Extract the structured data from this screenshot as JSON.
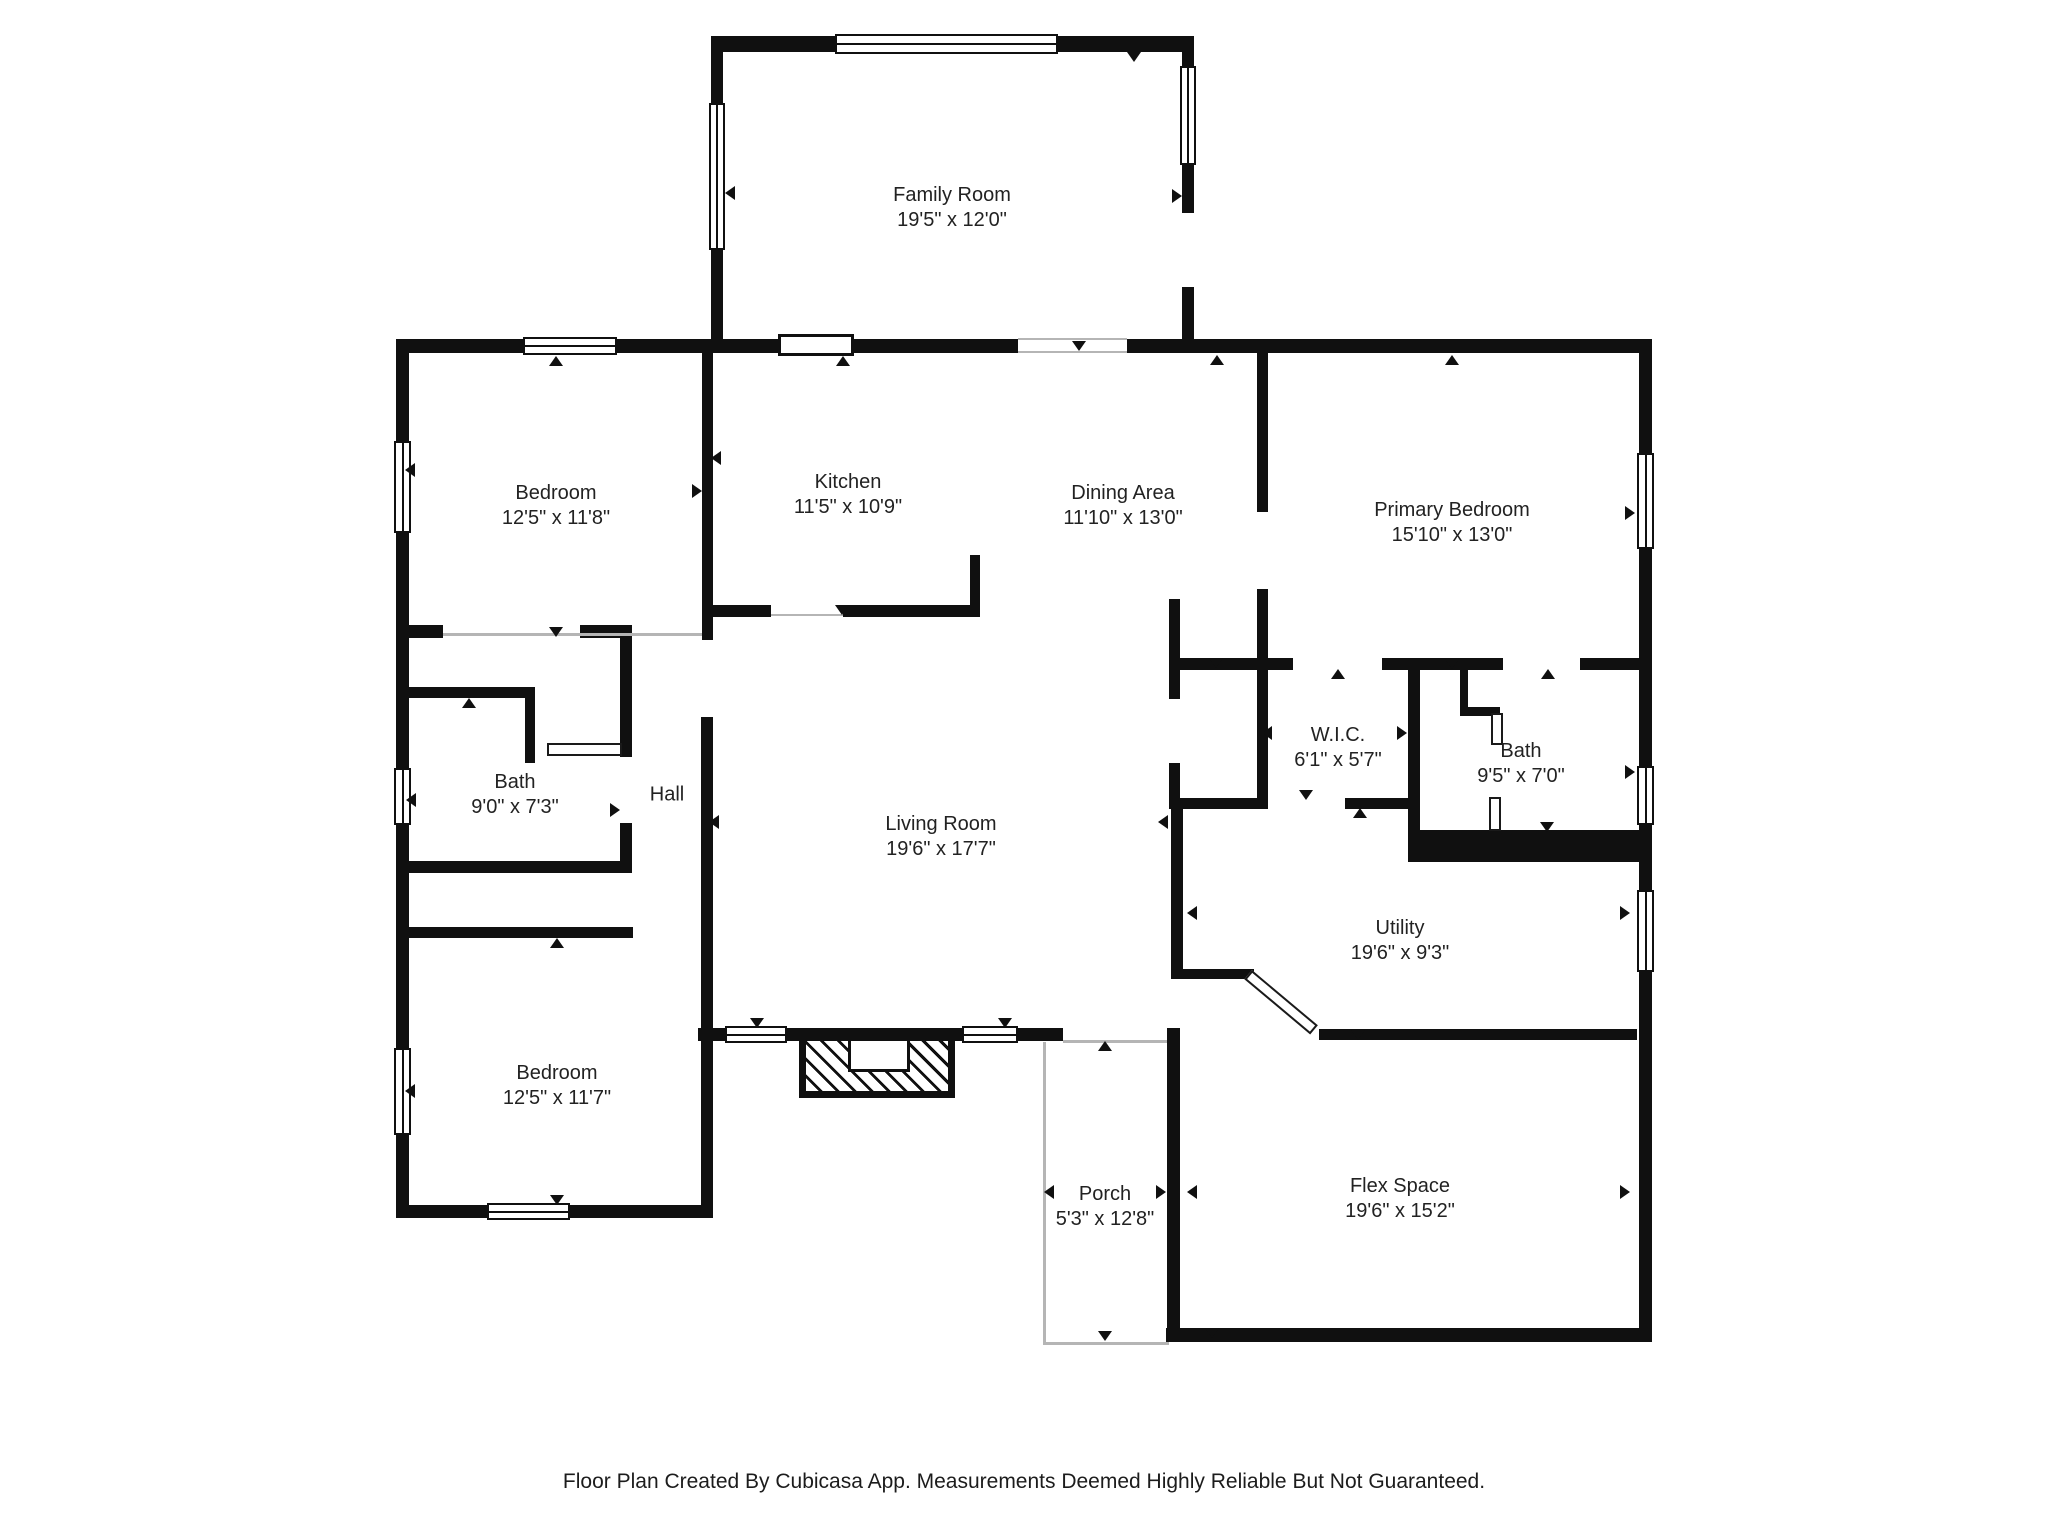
{
  "footer": {
    "text": "Floor Plan Created By Cubicasa App. Measurements Deemed Highly Reliable But Not Guaranteed."
  },
  "rooms": [
    {
      "id": "family-room",
      "name": "Family Room",
      "dims": "19'5\" x 12'0\"",
      "cx": 952,
      "cy": 208
    },
    {
      "id": "bedroom-top",
      "name": "Bedroom",
      "dims": "12'5\" x 11'8\"",
      "cx": 556,
      "cy": 506
    },
    {
      "id": "kitchen",
      "name": "Kitchen",
      "dims": "11'5\" x 10'9\"",
      "cx": 848,
      "cy": 495
    },
    {
      "id": "dining-area",
      "name": "Dining Area",
      "dims": "11'10\" x 13'0\"",
      "cx": 1123,
      "cy": 506
    },
    {
      "id": "primary-bedroom",
      "name": "Primary Bedroom",
      "dims": "15'10\" x 13'0\"",
      "cx": 1452,
      "cy": 523
    },
    {
      "id": "bath-left",
      "name": "Bath",
      "dims": "9'0\" x 7'3\"",
      "cx": 515,
      "cy": 795
    },
    {
      "id": "hall",
      "name": "Hall",
      "dims": "",
      "cx": 667,
      "cy": 795
    },
    {
      "id": "wic",
      "name": "W.I.C.",
      "dims": "6'1\" x 5'7\"",
      "cx": 1338,
      "cy": 748
    },
    {
      "id": "bath-right",
      "name": "Bath",
      "dims": "9'5\" x 7'0\"",
      "cx": 1521,
      "cy": 764
    },
    {
      "id": "living-room",
      "name": "Living Room",
      "dims": "19'6\" x 17'7\"",
      "cx": 941,
      "cy": 837
    },
    {
      "id": "utility",
      "name": "Utility",
      "dims": "19'6\" x 9'3\"",
      "cx": 1400,
      "cy": 941
    },
    {
      "id": "bedroom-bottom",
      "name": "Bedroom",
      "dims": "12'5\" x 11'7\"",
      "cx": 557,
      "cy": 1086
    },
    {
      "id": "flex-space",
      "name": "Flex Space",
      "dims": "19'6\" x 15'2\"",
      "cx": 1400,
      "cy": 1199
    },
    {
      "id": "porch",
      "name": "Porch",
      "dims": "5'3\" x 12'8\"",
      "cx": 1105,
      "cy": 1207
    }
  ],
  "plan": {
    "wall_color": "#101010",
    "walls": [
      [
        711,
        36,
        483,
        16
      ],
      [
        396,
        339,
        1256,
        14
      ],
      [
        713,
        605,
        267,
        12
      ],
      [
        408,
        625,
        224,
        13
      ],
      [
        408,
        687,
        127,
        11
      ],
      [
        408,
        861,
        224,
        12
      ],
      [
        408,
        927,
        225,
        11
      ],
      [
        396,
        1205,
        314,
        13
      ],
      [
        698,
        1028,
        365,
        13
      ],
      [
        1169,
        658,
        483,
        12
      ],
      [
        1169,
        798,
        251,
        11
      ],
      [
        1410,
        830,
        242,
        32
      ],
      [
        1460,
        707,
        40,
        9
      ],
      [
        1171,
        969,
        83,
        10
      ],
      [
        1319,
        1029,
        318,
        11
      ],
      [
        1166,
        1328,
        486,
        14
      ],
      [
        396,
        339,
        13,
        879
      ],
      [
        711,
        36,
        12,
        317
      ],
      [
        1182,
        36,
        12,
        317
      ],
      [
        702,
        353,
        11,
        287
      ],
      [
        701,
        717,
        12,
        501
      ],
      [
        970,
        555,
        10,
        62
      ],
      [
        1257,
        353,
        11,
        455
      ],
      [
        1169,
        599,
        11,
        210
      ],
      [
        1408,
        658,
        12,
        204
      ],
      [
        1639,
        339,
        13,
        1003
      ],
      [
        1171,
        809,
        12,
        170
      ],
      [
        620,
        627,
        12,
        246
      ],
      [
        525,
        687,
        10,
        76
      ],
      [
        1167,
        1028,
        13,
        314
      ],
      [
        1460,
        668,
        8,
        48
      ]
    ],
    "gaps": [
      [
        1018,
        338,
        109,
        16
      ],
      [
        1180,
        213,
        16,
        74
      ],
      [
        443,
        624,
        137,
        15
      ],
      [
        1257,
        512,
        13,
        77
      ],
      [
        1293,
        657,
        89,
        14
      ],
      [
        1503,
        657,
        77,
        14
      ],
      [
        1268,
        797,
        77,
        13
      ],
      [
        1169,
        699,
        13,
        64
      ],
      [
        771,
        604,
        72,
        14
      ],
      [
        620,
        757,
        14,
        66
      ]
    ],
    "windows": [
      {
        "x": 835,
        "y": 34,
        "w": 223,
        "h": 20,
        "o": "h"
      },
      {
        "x": 523,
        "y": 337,
        "w": 94,
        "h": 18,
        "o": "h"
      },
      {
        "x": 487,
        "y": 1203,
        "w": 83,
        "h": 17,
        "o": "h"
      },
      {
        "x": 725,
        "y": 1026,
        "w": 62,
        "h": 17,
        "o": "h"
      },
      {
        "x": 962,
        "y": 1026,
        "w": 56,
        "h": 17,
        "o": "h"
      },
      {
        "x": 709,
        "y": 103,
        "w": 16,
        "h": 147,
        "o": "v"
      },
      {
        "x": 1180,
        "y": 66,
        "w": 16,
        "h": 99,
        "o": "v"
      },
      {
        "x": 394,
        "y": 441,
        "w": 17,
        "h": 92,
        "o": "v"
      },
      {
        "x": 394,
        "y": 768,
        "w": 17,
        "h": 57,
        "o": "v"
      },
      {
        "x": 394,
        "y": 1048,
        "w": 17,
        "h": 87,
        "o": "v"
      },
      {
        "x": 1637,
        "y": 453,
        "w": 17,
        "h": 96,
        "o": "v"
      },
      {
        "x": 1637,
        "y": 766,
        "w": 17,
        "h": 59,
        "o": "v"
      },
      {
        "x": 1637,
        "y": 890,
        "w": 17,
        "h": 82,
        "o": "v"
      }
    ],
    "cased_openings": [
      [
        778,
        334,
        76,
        22
      ]
    ],
    "door_leaves": [
      [
        547,
        743,
        75,
        13
      ],
      [
        1491,
        713,
        12,
        32
      ],
      [
        1489,
        797,
        12,
        34
      ]
    ],
    "diagonal_door": {
      "x": 1252,
      "y": 970,
      "len": 86,
      "th": 12,
      "angle": 40
    },
    "thin_lines": [
      [
        443,
        633,
        259,
        3
      ],
      [
        1043,
        1042,
        3,
        302
      ],
      [
        1043,
        1342,
        126,
        3
      ],
      [
        1063,
        1040,
        104,
        3
      ],
      [
        1018,
        338,
        109,
        2
      ],
      [
        1018,
        351,
        109,
        2
      ],
      [
        771,
        614,
        72,
        2
      ]
    ],
    "arrows": [
      {
        "x": 556,
        "y": 361,
        "d": "up"
      },
      {
        "x": 843,
        "y": 361,
        "d": "up"
      },
      {
        "x": 1079,
        "y": 346,
        "d": "down"
      },
      {
        "x": 1217,
        "y": 360,
        "d": "up"
      },
      {
        "x": 1452,
        "y": 360,
        "d": "up"
      },
      {
        "x": 730,
        "y": 193,
        "d": "left"
      },
      {
        "x": 1177,
        "y": 196,
        "d": "right"
      },
      {
        "x": 1134,
        "y": 57,
        "d": "down"
      },
      {
        "x": 556,
        "y": 632,
        "d": "down"
      },
      {
        "x": 469,
        "y": 703,
        "d": "up"
      },
      {
        "x": 615,
        "y": 810,
        "d": "right"
      },
      {
        "x": 716,
        "y": 458,
        "d": "left"
      },
      {
        "x": 697,
        "y": 491,
        "d": "right"
      },
      {
        "x": 714,
        "y": 822,
        "d": "left"
      },
      {
        "x": 557,
        "y": 943,
        "d": "up"
      },
      {
        "x": 410,
        "y": 470,
        "d": "left"
      },
      {
        "x": 411,
        "y": 800,
        "d": "left"
      },
      {
        "x": 410,
        "y": 1091,
        "d": "left"
      },
      {
        "x": 557,
        "y": 1200,
        "d": "down"
      },
      {
        "x": 757,
        "y": 1023,
        "d": "down"
      },
      {
        "x": 1005,
        "y": 1023,
        "d": "down"
      },
      {
        "x": 1105,
        "y": 1046,
        "d": "up"
      },
      {
        "x": 1105,
        "y": 1336,
        "d": "down"
      },
      {
        "x": 1049,
        "y": 1192,
        "d": "left"
      },
      {
        "x": 1161,
        "y": 1192,
        "d": "right"
      },
      {
        "x": 1338,
        "y": 674,
        "d": "up"
      },
      {
        "x": 1548,
        "y": 674,
        "d": "up"
      },
      {
        "x": 1306,
        "y": 795,
        "d": "down"
      },
      {
        "x": 1360,
        "y": 813,
        "d": "up"
      },
      {
        "x": 1267,
        "y": 733,
        "d": "left"
      },
      {
        "x": 1402,
        "y": 733,
        "d": "right"
      },
      {
        "x": 1216,
        "y": 663,
        "d": "down"
      },
      {
        "x": 1547,
        "y": 827,
        "d": "down"
      },
      {
        "x": 1630,
        "y": 513,
        "d": "right"
      },
      {
        "x": 1630,
        "y": 772,
        "d": "right"
      },
      {
        "x": 1452,
        "y": 664,
        "d": "down"
      },
      {
        "x": 1163,
        "y": 822,
        "d": "left"
      },
      {
        "x": 1192,
        "y": 913,
        "d": "left"
      },
      {
        "x": 1625,
        "y": 913,
        "d": "right"
      },
      {
        "x": 1358,
        "y": 1035,
        "d": "down"
      },
      {
        "x": 1192,
        "y": 1192,
        "d": "left"
      },
      {
        "x": 1625,
        "y": 1192,
        "d": "right"
      },
      {
        "x": 1212,
        "y": 1333,
        "d": "down"
      },
      {
        "x": 842,
        "y": 610,
        "d": "down"
      }
    ]
  }
}
